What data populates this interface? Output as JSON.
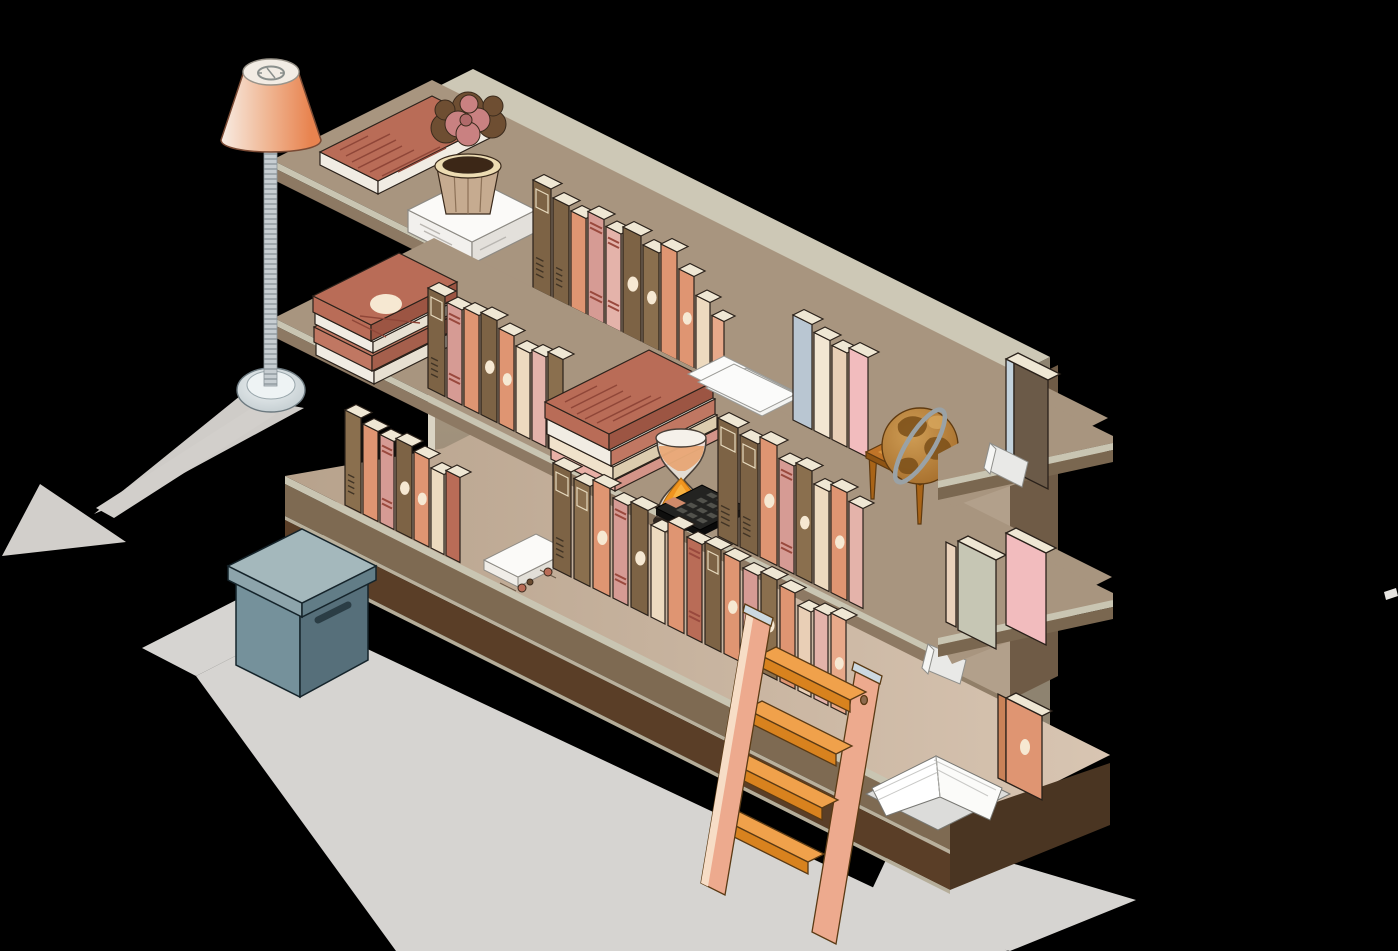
{
  "scene": {
    "label": "Isometric bookshelf illustration on black background",
    "background": "#000000"
  },
  "palette": {
    "floor": "#d6d4d1",
    "floorShadow": "#cfccc8",
    "arrow": "#d2cfcb",
    "panelFront": "#b2a794",
    "panelTop": "#cdc8b6",
    "panelSide": "#8e8370",
    "panelEdge": "#dad4c4",
    "shelfTop": "#a8957f",
    "shelfTrim": "#c9c5b2",
    "shelfFace": "#8d7963",
    "platformTop": "#cfbaa7",
    "platformFace1": "#7e6a52",
    "platformFace2": "#5a3e27",
    "platformSide": "#4a3522",
    "columnLeft": "#b2a08b",
    "columnRight": "#6f5b46",
    "stubTop": "#a8957f",
    "stubFace": "#7a6750",
    "boxLidTop": "#a4b8bc",
    "boxLidSW": "#8da4ab",
    "boxLidSE": "#627d87",
    "boxBodySW": "#75919b",
    "boxBodySE": "#566f7a",
    "lampPole": "#c7ced2",
    "lampBase": "#dfe7e9",
    "shadeLight": "#f8ece3",
    "shadeDark": "#e8834f",
    "potBody": "#c6ab90",
    "potRim": "#eddcb3",
    "potSoil": "#3c2717",
    "flowerPink": "#c98181",
    "flowerDark": "#6e4e32",
    "globeSphere": "#b5772c",
    "globeLand": "#7e521b",
    "globeRing": "#9aa2a6",
    "tableWood": "#c07428",
    "tableLeg": "#a96417",
    "sandOrange": "#f0941f",
    "calcBody": "#232321",
    "calcKey": "#52524c",
    "calcAccent": "#d08a6a",
    "ladderRail": "#edaa8e",
    "ladderRailEdge": "#f7ddc6",
    "stepTop": "#f0a14b",
    "stepFace": "#d8821e",
    "metalCap": "#ccd9e1",
    "paper": "#fbfbfa",
    "pages": "#efe7d4",
    "redBook": "#b96c57",
    "books": {
      "brown": "#7d6345",
      "brown2": "#8a6f4e",
      "salmon": "#df9572",
      "salmon2": "#e8a98a",
      "pink": "#d69b94",
      "pink2": "#e4b3aa",
      "cream": "#eddabf",
      "cream2": "#f3e6d2",
      "red": "#b96c57",
      "sage": "#c6c6b4",
      "blue": "#b9c6d2",
      "rose": "#f2bcbe",
      "tan": "#e9cfb6",
      "white": "#f6f3ee"
    }
  },
  "objects": {
    "lamp": {
      "label": "floor lamp with salmon shade"
    },
    "shelf": {
      "label": "three-tier isometric bookshelf with back panel"
    },
    "plant": {
      "label": "potted plant on white book"
    },
    "globe": {
      "label": "globe on small wooden table"
    },
    "hourglass": {
      "label": "hourglass with orange sand"
    },
    "calculator": {
      "label": "black calculator"
    },
    "ladder": {
      "label": "wooden step ladder leaning on shelf"
    },
    "box": {
      "label": "slate storage box with lid"
    },
    "openBook": {
      "label": "open white book on base platform"
    },
    "arrow": {
      "label": "gray arrow on floor pointing lower left"
    }
  },
  "book_rows": [
    {
      "name": "top-shelf-row",
      "x": 533,
      "y": 288,
      "gap": 2,
      "books": [
        [
          18,
          108,
          "brown",
          "label-ridges"
        ],
        [
          16,
          100,
          "brown",
          "ridges"
        ],
        [
          15,
          96,
          "salmon",
          "plain"
        ],
        [
          16,
          104,
          "pink",
          "stripes"
        ],
        [
          15,
          98,
          "pink2",
          "stripes"
        ],
        [
          18,
          106,
          "brown",
          "oval"
        ],
        [
          16,
          98,
          "brown2",
          "oval"
        ],
        [
          16,
          108,
          "salmon",
          "plain"
        ],
        [
          15,
          92,
          "salmon",
          "oval"
        ],
        [
          14,
          74,
          "cream",
          "plain"
        ],
        [
          12,
          62,
          "salmon2",
          "plain"
        ]
      ]
    },
    {
      "name": "middle-shelf-left-row",
      "x": 428,
      "y": 388,
      "gap": 2,
      "books": [
        [
          17,
          100,
          "brown",
          "label-ridges"
        ],
        [
          15,
          95,
          "pink",
          "stripes"
        ],
        [
          15,
          98,
          "salmon",
          "plain"
        ],
        [
          16,
          102,
          "brown",
          "oval"
        ],
        [
          15,
          95,
          "salmon",
          "oval"
        ],
        [
          14,
          86,
          "cream",
          "plain"
        ],
        [
          14,
          90,
          "pink2",
          "plain"
        ],
        [
          15,
          96,
          "brown2",
          "ridges"
        ]
      ]
    },
    {
      "name": "middle-shelf-right-row",
      "x": 718,
      "y": 536,
      "gap": 2,
      "books": [
        [
          20,
          118,
          "brown",
          "label-ridges"
        ],
        [
          18,
          112,
          "brown",
          "label-ridges"
        ],
        [
          17,
          120,
          "salmon",
          "oval"
        ],
        [
          15,
          108,
          "pink",
          "stripes"
        ],
        [
          16,
          112,
          "brown2",
          "oval"
        ],
        [
          15,
          100,
          "cream",
          "plain"
        ],
        [
          16,
          108,
          "salmon",
          "oval"
        ],
        [
          14,
          100,
          "pink2",
          "plain"
        ]
      ]
    },
    {
      "name": "bottom-left-row",
      "x": 345,
      "y": 505,
      "gap": 2,
      "books": [
        [
          16,
          95,
          "brown2",
          "ridges"
        ],
        [
          15,
          90,
          "salmon",
          "plain"
        ],
        [
          14,
          88,
          "pink",
          "stripes"
        ],
        [
          16,
          92,
          "brown",
          "oval"
        ],
        [
          15,
          88,
          "salmon",
          "oval"
        ],
        [
          13,
          80,
          "cream",
          "plain"
        ],
        [
          14,
          85,
          "red",
          "plain"
        ]
      ]
    },
    {
      "name": "bottom-long-row",
      "x": 553,
      "y": 568,
      "gap": 3,
      "books": [
        [
          18,
          105,
          "brown",
          "label-ridges"
        ],
        [
          16,
          100,
          "brown2",
          "label"
        ],
        [
          17,
          108,
          "salmon",
          "oval"
        ],
        [
          15,
          100,
          "pink",
          "stripes"
        ],
        [
          17,
          105,
          "brown",
          "oval"
        ],
        [
          14,
          92,
          "cream",
          "plain"
        ],
        [
          16,
          104,
          "salmon",
          "plain"
        ],
        [
          15,
          98,
          "red",
          "stripes"
        ],
        [
          16,
          102,
          "brown",
          "label"
        ],
        [
          16,
          100,
          "salmon",
          "oval"
        ],
        [
          15,
          95,
          "pink",
          "plain"
        ],
        [
          16,
          100,
          "brown2",
          "oval"
        ],
        [
          15,
          96,
          "salmon",
          "plain"
        ],
        [
          13,
          85,
          "tan",
          "plain"
        ],
        [
          14,
          90,
          "pink2",
          "plain"
        ],
        [
          15,
          94,
          "salmon2",
          "oval"
        ]
      ]
    },
    {
      "name": "pastel-group",
      "x": 793,
      "y": 420,
      "gap": 2,
      "books": [
        [
          19,
          105,
          "blue",
          "plain"
        ],
        [
          16,
          98,
          "cream2",
          "plain"
        ],
        [
          15,
          94,
          "tan",
          "plain"
        ],
        [
          19,
          100,
          "rose",
          "plain"
        ]
      ]
    }
  ]
}
